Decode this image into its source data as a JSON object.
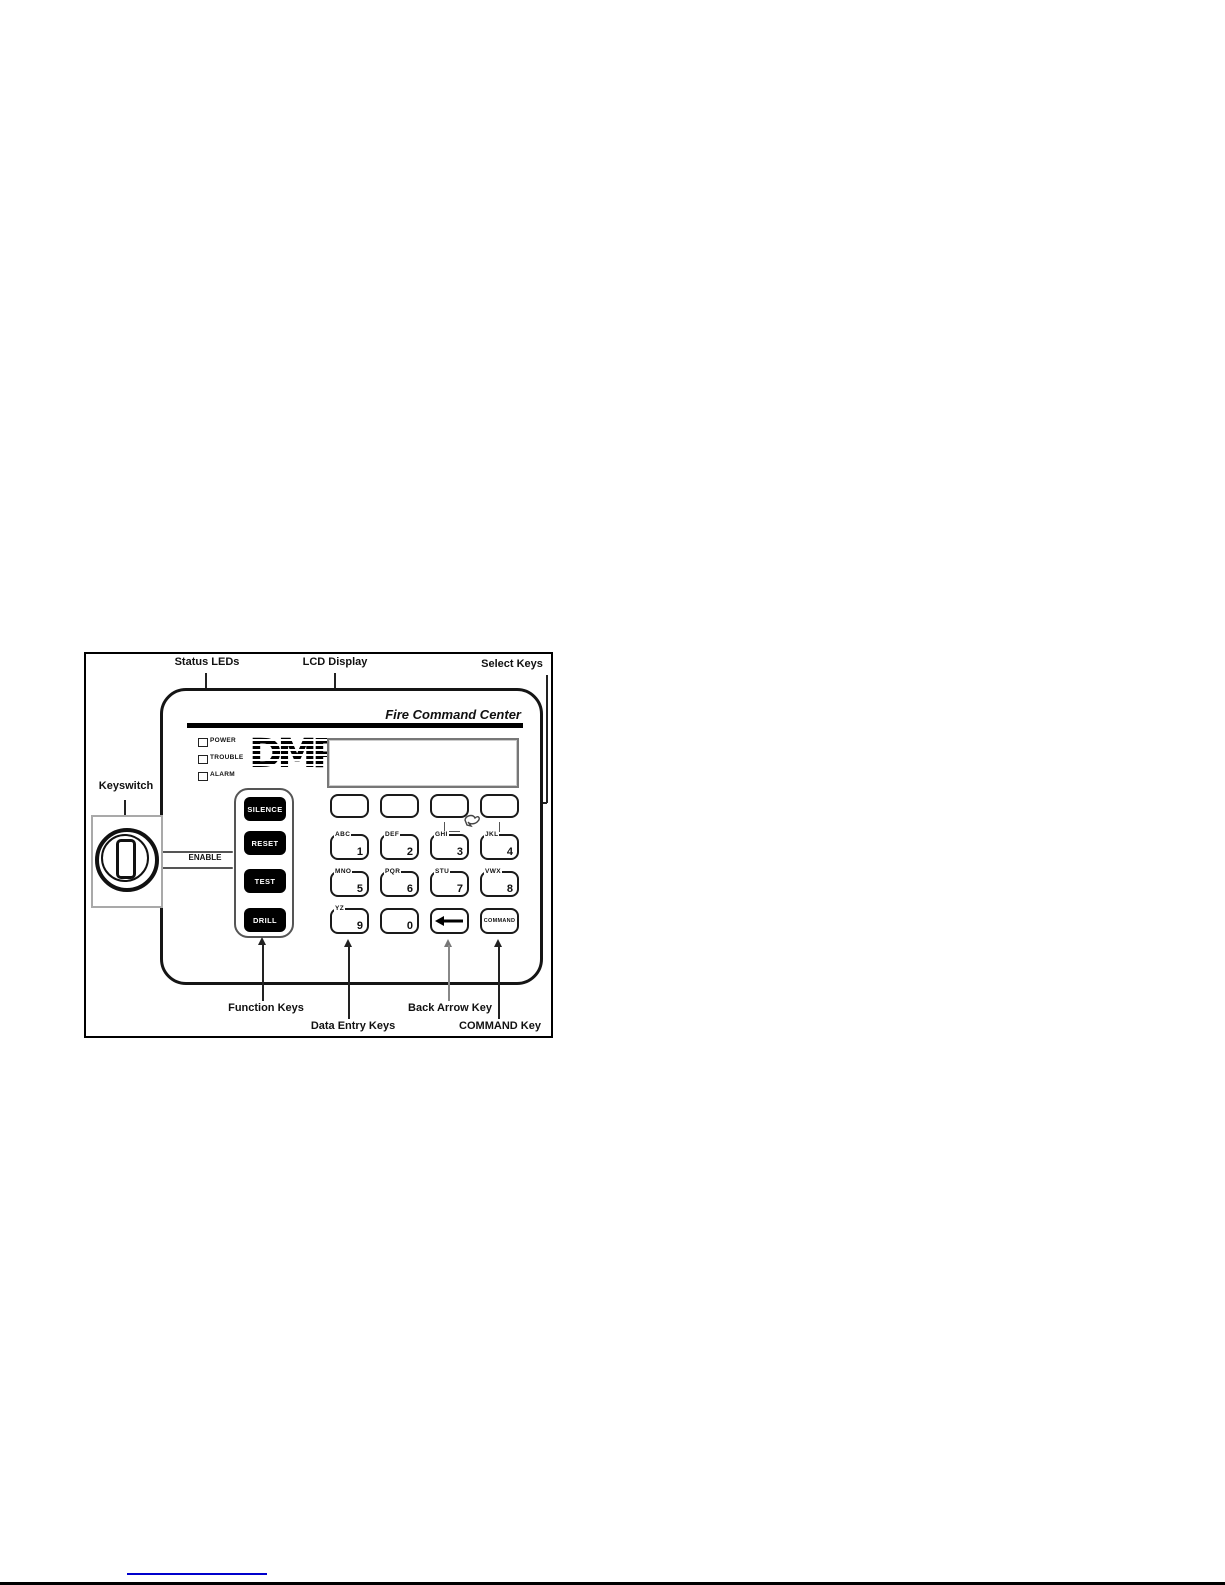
{
  "figure": {
    "labels": {
      "status_leds": "Status LEDs",
      "lcd_display": "LCD Display",
      "select_keys": "Select Keys",
      "keyswitch": "Keyswitch",
      "enable": "ENABLE",
      "function_keys": "Function Keys",
      "data_entry_keys": "Data Entry Keys",
      "back_arrow_key": "Back Arrow Key",
      "command_key": "COMMAND Key"
    },
    "panel": {
      "title": "Fire Command Center",
      "logo": "DMP",
      "status_leds": [
        {
          "label": "POWER"
        },
        {
          "label": "TROUBLE"
        },
        {
          "label": "ALARM"
        }
      ],
      "lcd_text": "",
      "function_keys": [
        {
          "label": "SILENCE"
        },
        {
          "label": "RESET"
        },
        {
          "label": "TEST"
        },
        {
          "label": "DRILL"
        }
      ],
      "keypad": [
        [
          {
            "letters": "ABC",
            "digit": "1"
          },
          {
            "letters": "DEF",
            "digit": "2"
          },
          {
            "letters": "GHI",
            "digit": "3"
          },
          {
            "letters": "JKL",
            "digit": "4"
          }
        ],
        [
          {
            "letters": "MNO",
            "digit": "5"
          },
          {
            "letters": "PQR",
            "digit": "6"
          },
          {
            "letters": "STU",
            "digit": "7"
          },
          {
            "letters": "VWX",
            "digit": "8"
          }
        ],
        [
          {
            "letters": "YZ",
            "digit": "9"
          },
          {
            "letters": "",
            "digit": "0"
          }
        ]
      ],
      "command_key": {
        "label": "COMMAND"
      }
    },
    "colors": {
      "link_blue": "#0000cc",
      "ink": "#111111"
    }
  }
}
